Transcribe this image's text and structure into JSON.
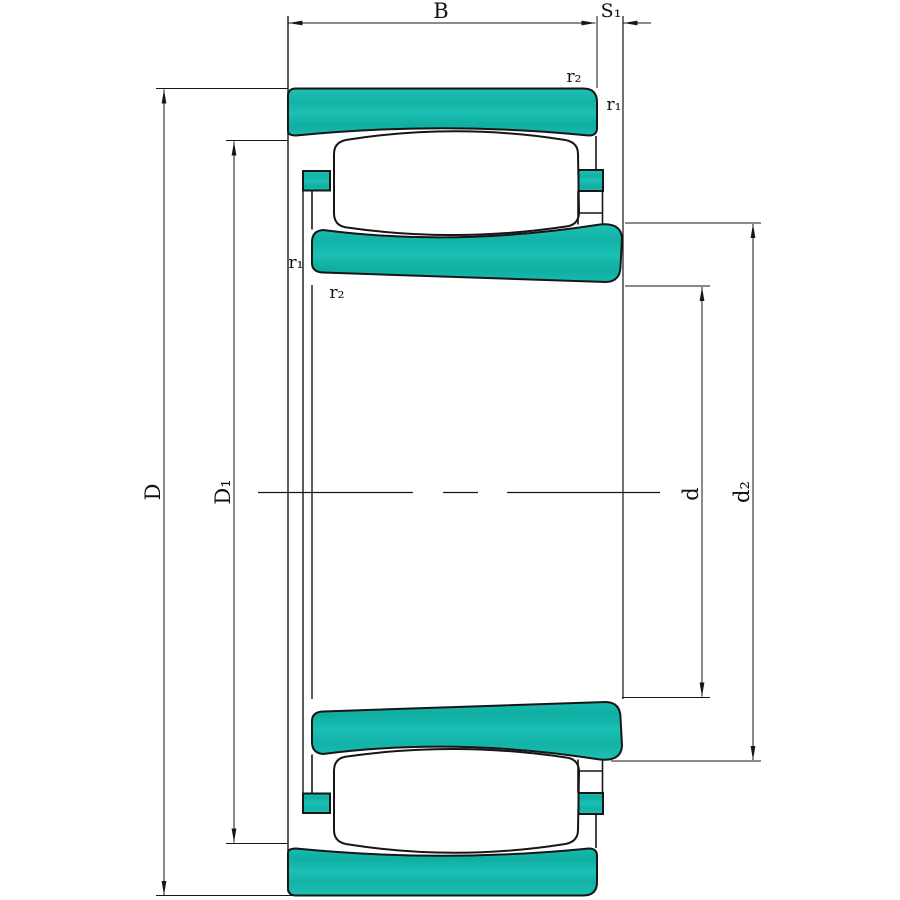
{
  "drawing": {
    "kind": "bearing cross-section technical drawing",
    "colors": {
      "ring_fill": "#17b9ad",
      "ring_fill_light": "#1fc0b4",
      "ring_fill_dark": "#0fada2",
      "outline": "#161616",
      "background": "#ffffff"
    },
    "labels": {
      "width_B": "B",
      "s1": "S₁",
      "r2_top_right": "r₂",
      "r1_top_right": "r₁",
      "r1_left": "r₁",
      "r2_left": "r₂",
      "outer_diameter_D": "D",
      "diameter_D1": "D₁",
      "bore_diameter_d": "d",
      "diameter_d2": "d₂"
    }
  }
}
